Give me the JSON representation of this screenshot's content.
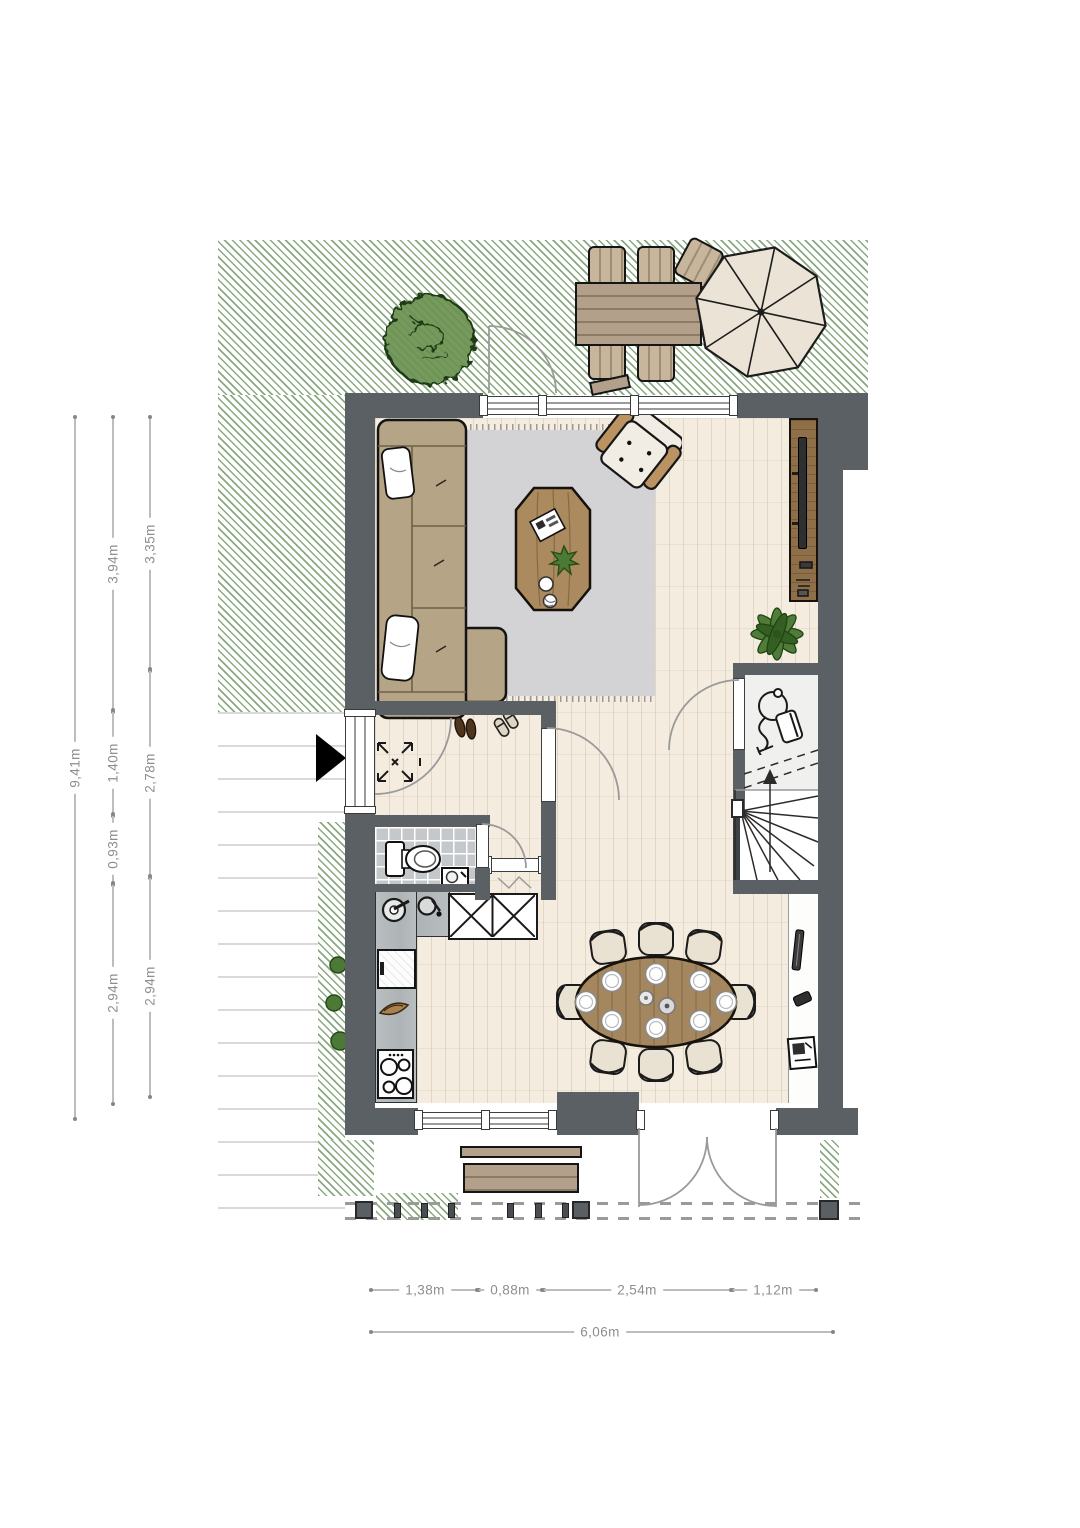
{
  "plan": {
    "type": "floor-plan",
    "floor": "ground-floor"
  },
  "dimensions": {
    "left": {
      "total": "9,41m",
      "col_inner": [
        "3,94m",
        "1,40m",
        "0,93m",
        "2,94m"
      ],
      "col_outer": [
        "3,35m",
        "2,78m",
        "2,94m"
      ]
    },
    "bottom": {
      "segments": [
        "1,38m",
        "0,88m",
        "2,54m",
        "1,12m"
      ],
      "total": "6,06m"
    }
  },
  "colors": {
    "wall": "#5b6065",
    "garden_hatch": "#8aa981",
    "wood_floor": "#f4ecdf",
    "rug": "#d3d3d6",
    "counter": "#b6bcbe",
    "furniture_wood": "#a8885c",
    "dimension_text": "#8e8e8e"
  },
  "icons": {
    "entrance": "entrance-arrow",
    "stairs_direction": "up-arrow",
    "meter_cabinet": "x-cross-symbol",
    "storage_closet": "vacuum-cleaner-icon"
  }
}
